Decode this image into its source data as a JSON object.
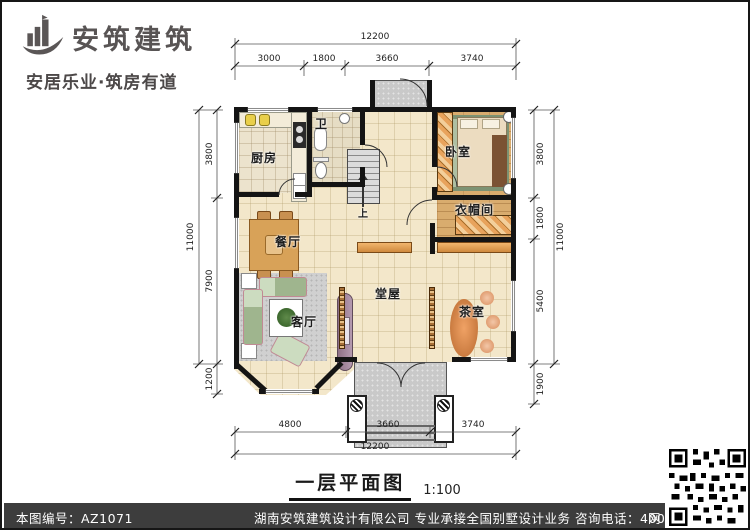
{
  "brand": {
    "name": "安筑建筑",
    "tagline": "安居乐业·筑房有道"
  },
  "plan": {
    "rooms": {
      "kitchen": "厨房",
      "bath": "卫",
      "bedroom": "卧室",
      "cloakroom": "衣帽间",
      "dining": "餐厅",
      "hall": "堂屋",
      "living": "客厅",
      "tea": "茶室"
    },
    "stair_up": "上",
    "watermark": "安筑建筑",
    "dims": {
      "top_total": "12200",
      "top_segments": [
        "3000",
        "1800",
        "3660",
        "3740"
      ],
      "bottom_segments": [
        "4800",
        "3660",
        "3740"
      ],
      "bottom_total": "12200",
      "left_total": "11000",
      "left_segments": [
        "3800",
        "7900",
        "1200"
      ],
      "right_total": "11000",
      "right_segments": [
        "3800",
        "1800",
        "5400",
        "1900"
      ]
    }
  },
  "caption": {
    "title": "一层平面图",
    "scale": "1:100"
  },
  "footer": {
    "drawing_no": "本图编号：AZ1071",
    "company": "湖南安筑建筑设计有限公司  专业承接全国别墅设计业务  咨询电话：400-8070-511",
    "web": "网"
  }
}
